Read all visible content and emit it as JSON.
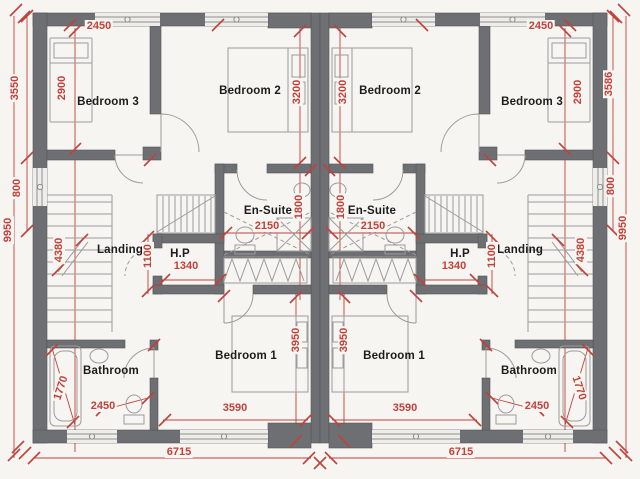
{
  "document": {
    "type": "architectural floor plan",
    "description": "Mirrored semi-detached first floor plan with bedrooms, en-suites, bathrooms, landings and stairs"
  },
  "colors": {
    "paper": "#f7f5f1",
    "wall": "#6e6f72",
    "dimension_red": "#c2413b",
    "label_black": "#1c1c1c",
    "furniture_outline": "#9c9c9c"
  },
  "rooms": {
    "bedroom1": "Bedroom 1",
    "bedroom2": "Bedroom 2",
    "bedroom3": "Bedroom 3",
    "ensuite": "En-Suite",
    "hot_press": "H.P",
    "landing": "Landing",
    "bathroom": "Bathroom"
  },
  "dimensions": {
    "bedroom3_width": "2450",
    "bedroom3_depth": "2900",
    "front_block_depth_left": "3550",
    "front_block_depth_right": "3586",
    "bedroom2_depth": "3200",
    "stair_window": "800",
    "overall_depth": "9950",
    "stair_run": "4380",
    "landing_width": "1100",
    "hot_press_width": "1340",
    "ensuite_width": "2150",
    "ensuite_depth": "1800",
    "bedroom1_width": "3590",
    "bedroom1_depth": "3950",
    "bathroom_diagonal": "1770",
    "bathroom_width": "2450",
    "unit_width": "6715"
  }
}
